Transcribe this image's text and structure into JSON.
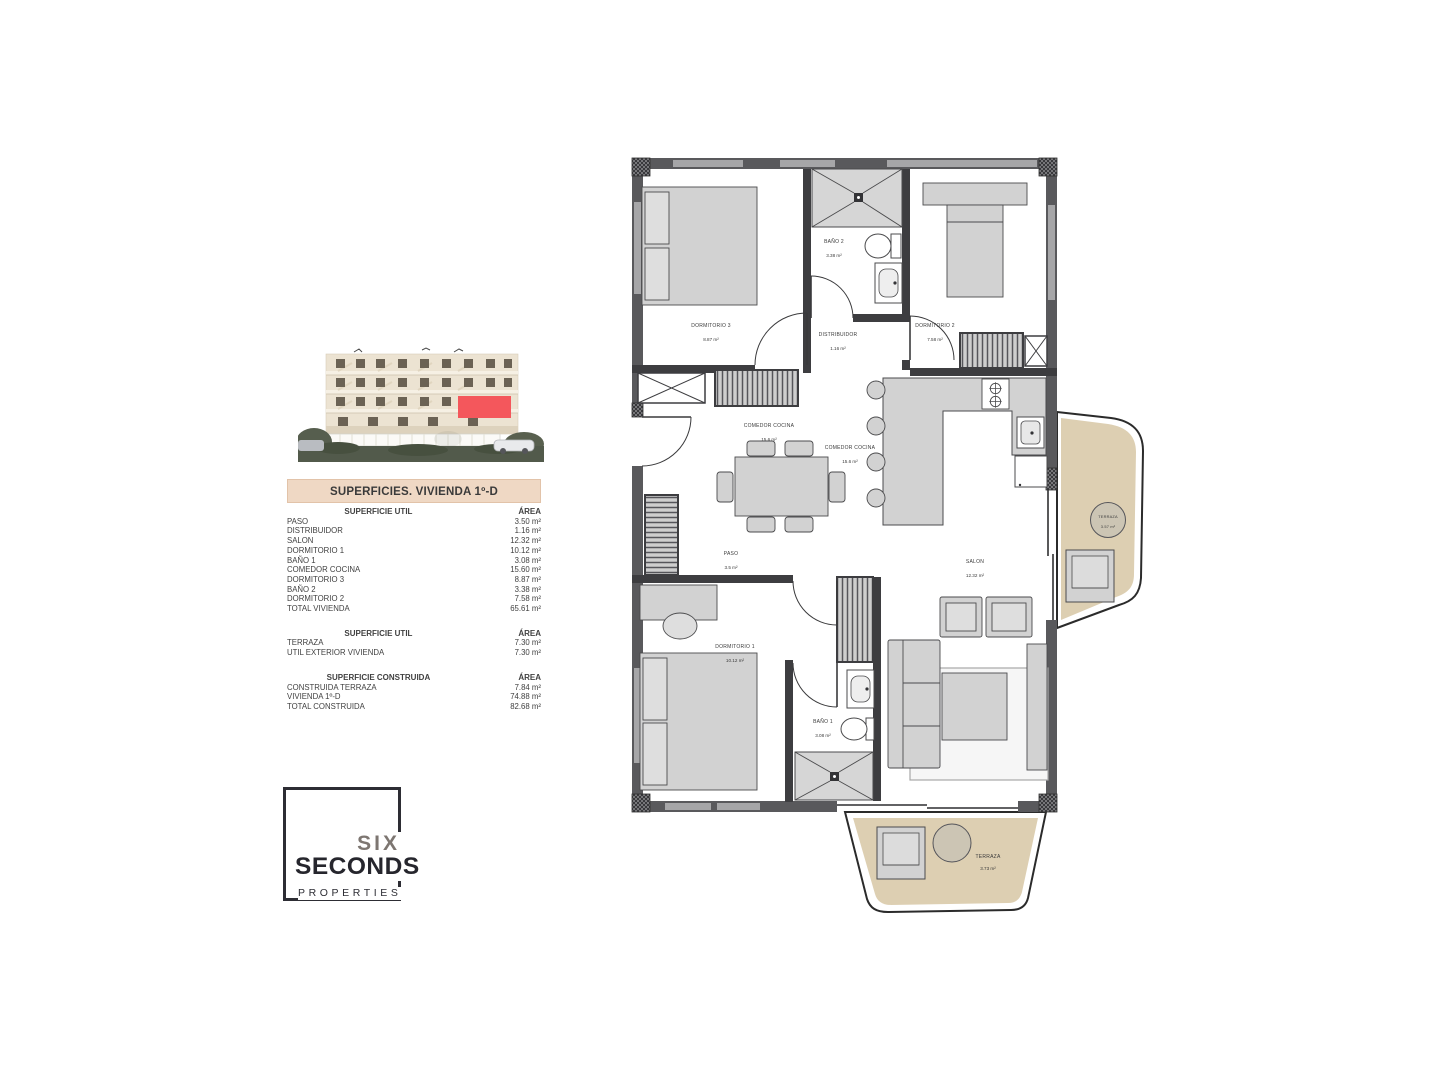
{
  "page": {
    "background": "#ffffff"
  },
  "building_render": {
    "highlight_color": "#f4575c",
    "facade_color": "#ece3d2"
  },
  "info_panel": {
    "title": "SUPERFICIES. VIVIENDA 1º-D",
    "title_bg": "#efd8c4",
    "sections": [
      {
        "header": {
          "label": "SUPERFICIE UTIL",
          "area": "ÁREA"
        },
        "rows": [
          {
            "label": "PASO",
            "area": "3.50 m²"
          },
          {
            "label": "DISTRIBUIDOR",
            "area": "1.16 m²"
          },
          {
            "label": "SALON",
            "area": "12.32 m²"
          },
          {
            "label": "DORMITORIO 1",
            "area": "10.12 m²"
          },
          {
            "label": "BAÑO 1",
            "area": "3.08 m²"
          },
          {
            "label": "COMEDOR COCINA",
            "area": "15.60 m²"
          },
          {
            "label": "DORMITORIO 3",
            "area": "8.87 m²"
          },
          {
            "label": "BAÑO 2",
            "area": "3.38 m²"
          },
          {
            "label": "DORMITORIO 2",
            "area": "7.58 m²"
          },
          {
            "label": "TOTAL VIVIENDA",
            "area": "65.61 m²"
          }
        ]
      },
      {
        "header": {
          "label": "SUPERFICIE UTIL",
          "area": "ÁREA"
        },
        "rows": [
          {
            "label": "TERRAZA",
            "area": "7.30 m²"
          },
          {
            "label": "UTIL EXTERIOR VIVIENDA",
            "area": "7.30 m²"
          }
        ]
      },
      {
        "header": {
          "label": "SUPERFICIE CONSTRUIDA",
          "area": "ÁREA"
        },
        "rows": [
          {
            "label": "CONSTRUIDA TERRAZA",
            "area": "7.84 m²"
          },
          {
            "label": "VIVIENDA 1º-D",
            "area": "74.88 m²"
          },
          {
            "label": "TOTAL CONSTRUIDA",
            "area": "82.68 m²"
          }
        ]
      }
    ]
  },
  "logo": {
    "line1": "SIX",
    "line2": "SECONDS",
    "line3": "PROPERTIES"
  },
  "floor_plan": {
    "colors": {
      "wall": "#3d3d40",
      "exterior_wall": "#59595c",
      "furniture": "#d2d2d2",
      "terrace": "#ddcfb2"
    },
    "rooms": [
      {
        "name": "DORMITORIO 3",
        "area": "8.87 m²"
      },
      {
        "name": "BAÑO 2",
        "area": "3.38 m²"
      },
      {
        "name": "DISTRIBUIDOR",
        "area": "1.16 m²"
      },
      {
        "name": "DORMITORIO 2",
        "area": "7.58 m²"
      },
      {
        "name": "COMEDOR COCINA",
        "area": "15.6 m²"
      },
      {
        "name": "COMEDOR COCINA",
        "area": "15.6 m²"
      },
      {
        "name": "PASO",
        "area": "3.5 m²"
      },
      {
        "name": "SALON",
        "area": "12.32 m²"
      },
      {
        "name": "DORMITORIO 1",
        "area": "10.12 m²"
      },
      {
        "name": "BAÑO 1",
        "area": "3.08 m²"
      },
      {
        "name": "TERRAZA",
        "area": "3.57 m²"
      },
      {
        "name": "TERRAZA",
        "area": "3.73 m²"
      }
    ]
  }
}
